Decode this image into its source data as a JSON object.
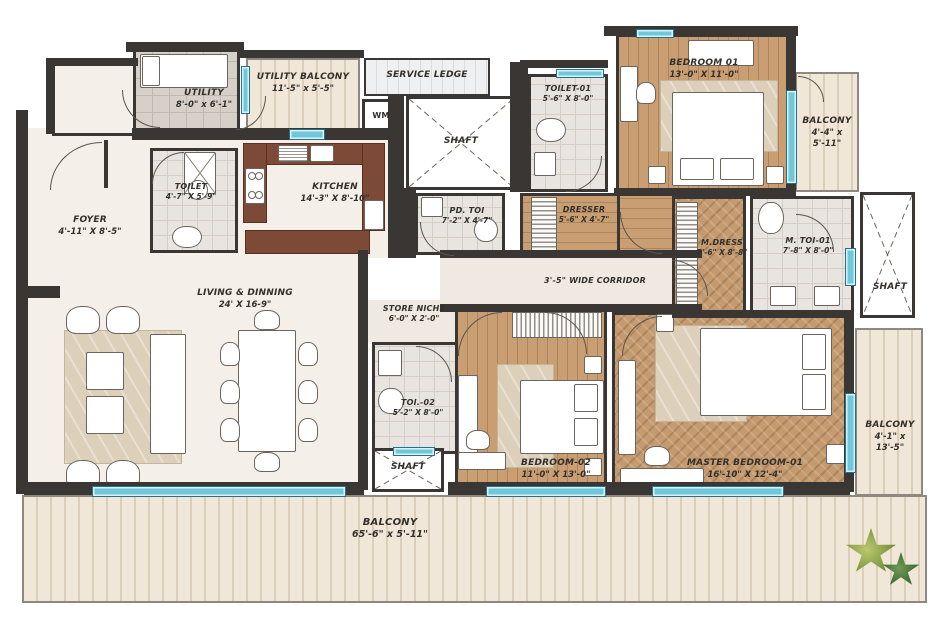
{
  "plan_title": "Apartment Floor Plan",
  "rooms": [
    {
      "id": "utility",
      "label": "UTILITY",
      "dims": "8'-0\" x 6'-1\""
    },
    {
      "id": "utility_balcony",
      "label": "UTILITY BALCONY",
      "dims": "11'-5\" x 5'-5\""
    },
    {
      "id": "service_ledge",
      "label": "SERVICE LEDGE",
      "dims": ""
    },
    {
      "id": "wm",
      "label": "WM",
      "dims": ""
    },
    {
      "id": "shaft_top",
      "label": "SHAFT",
      "dims": ""
    },
    {
      "id": "toilet_01",
      "label": "TOILET-01",
      "dims": "5'-6\" X 8'-0\""
    },
    {
      "id": "bedroom_01",
      "label": "BEDROOM 01",
      "dims": "13'-0\" X 11'-0\""
    },
    {
      "id": "balcony_top_right",
      "label": "BALCONY",
      "dims": "4'-4\" x 5'-11\""
    },
    {
      "id": "toilet",
      "label": "TOILET",
      "dims": "4'-7\" X 5'-9\""
    },
    {
      "id": "kitchen",
      "label": "KITCHEN",
      "dims": "14'-3\" X 8'-10\""
    },
    {
      "id": "foyer",
      "label": "FOYER",
      "dims": "4'-11\" X 8'-5\""
    },
    {
      "id": "pd_toi",
      "label": "PD. TOI",
      "dims": "7'-2\" X 4'-7\""
    },
    {
      "id": "dresser",
      "label": "DRESSER",
      "dims": "5'-6\" X 4'-7\""
    },
    {
      "id": "corridor",
      "label": "3'-5\" WIDE CORRIDOR",
      "dims": ""
    },
    {
      "id": "m_dress",
      "label": "M.DRESS",
      "dims": "5'-6\" X 8'-8\""
    },
    {
      "id": "m_toi_01",
      "label": "M. TOI-01",
      "dims": "7'-8\" X 8'-0\""
    },
    {
      "id": "shaft_right",
      "label": "SHAFT",
      "dims": ""
    },
    {
      "id": "living_dining",
      "label": "LIVING & DINNING",
      "dims": "24' X 16-9\""
    },
    {
      "id": "store_niche",
      "label": "STORE NICHE",
      "dims": "6'-0\" X 2'-0\""
    },
    {
      "id": "toi_02",
      "label": "TOI.-02",
      "dims": "5'-2\" X 8'-0\""
    },
    {
      "id": "shaft_bottom",
      "label": "SHAFT",
      "dims": ""
    },
    {
      "id": "bedroom_02",
      "label": "BEDROOM-02",
      "dims": "11'-0\" X 13'-0\""
    },
    {
      "id": "master_bedroom",
      "label": "MASTER BEDROOM-01",
      "dims": "16'-10\" X 12'-4\""
    },
    {
      "id": "balcony_right",
      "label": "BALCONY",
      "dims": "4'-1\" x 13'-5\""
    },
    {
      "id": "balcony_bottom",
      "label": "BALCONY",
      "dims": "65'-6\" x 5'-11\""
    }
  ],
  "colors": {
    "wall": "#3a3633",
    "window": "#6fc8d9",
    "wood_floor": "#c89e72",
    "kitchen_counter": "#7c4a36",
    "marble_floor": "#f4efe8",
    "balcony_floor": "#f0e7d8"
  }
}
